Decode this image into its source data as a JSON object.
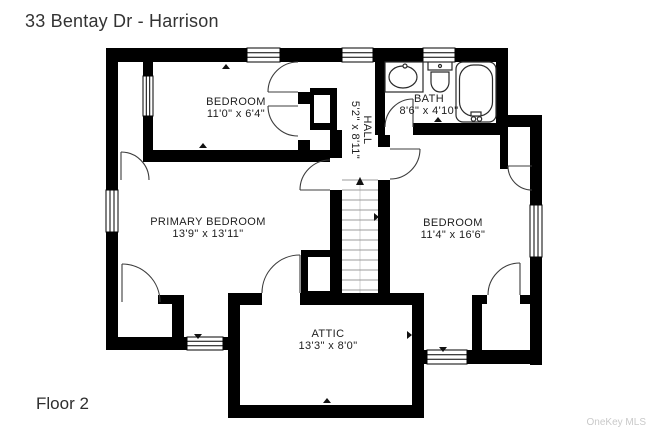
{
  "header": {
    "title": "33 Bentay Dr - Harrison"
  },
  "footer": {
    "floor_label": "Floor 2",
    "watermark": "OneKey MLS"
  },
  "rooms": {
    "bedroom_top": {
      "name": "BEDROOM",
      "dims": "11'0\" x 6'4\""
    },
    "bath": {
      "name": "BATH",
      "dims": "8'6\" x 4'10\""
    },
    "hall": {
      "name": "HALL",
      "dims": "5'2\" x 8'11\""
    },
    "primary": {
      "name": "PRIMARY BEDROOM",
      "dims": "13'9\" x 13'11\""
    },
    "bedroom_right": {
      "name": "BEDROOM",
      "dims": "11'4\" x 16'6\""
    },
    "attic": {
      "name": "ATTIC",
      "dims": "13'3\" x 8'0\""
    }
  },
  "colors": {
    "wall": "#000000",
    "background": "#ffffff",
    "title_text": "#333333",
    "watermark": "#c9c9c9"
  }
}
